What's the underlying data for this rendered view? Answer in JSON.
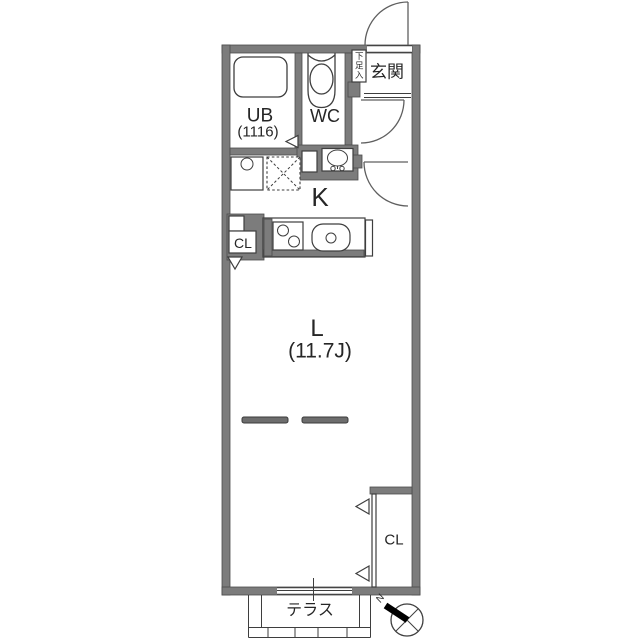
{
  "title": "1K apartment floor plan",
  "colors": {
    "wall": "#7c7c7c",
    "line": "#3e3e3e",
    "text": "#262626",
    "bg": "#ffffff"
  },
  "rooms": {
    "entrance": {
      "label": "玄関"
    },
    "shoe_cabinet": {
      "label": "下足入"
    },
    "bath": {
      "label": "UB",
      "size": "(1116)"
    },
    "toilet": {
      "label": "WC"
    },
    "kitchen": {
      "label": "K"
    },
    "kitchen_closet": {
      "label": "CL"
    },
    "living": {
      "label": "L",
      "size": "(11.7J)"
    },
    "main_closet": {
      "label": "CL"
    },
    "terrace": {
      "label": "テラス"
    }
  },
  "compass": {
    "label": "N"
  }
}
